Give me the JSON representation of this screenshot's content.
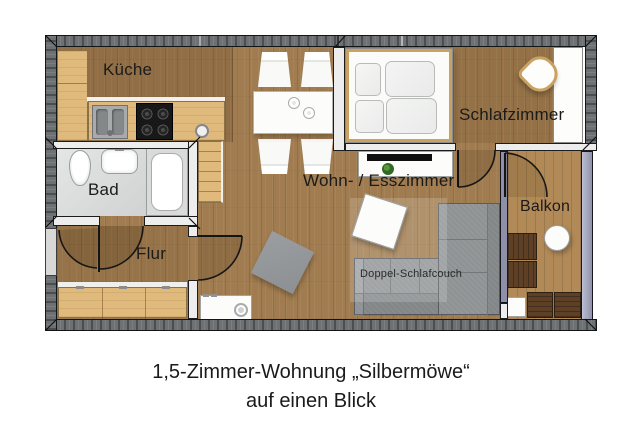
{
  "labels": {
    "kueche": "Küche",
    "bad": "Bad",
    "flur": "Flur",
    "wohn_esszimmer": "Wohn- / Esszimmer",
    "schlafzimmer": "Schlafzimmer",
    "balkon": "Balkon",
    "schlafcouch": "Doppel-Schlafcouch"
  },
  "caption": {
    "line1": "1,5-Zimmer-Wohnung „Silbermöwe“",
    "line2": "auf einen Blick"
  },
  "colors": {
    "wall-dark": "#6d7173",
    "wall-light": "#ededed",
    "wood-floor": "#a07c50",
    "wood-furniture": "#e0ba7d",
    "balcony-wood": "#b28a58",
    "railing-slate": "#9fa2bd",
    "divider-slate": "#8d90a8",
    "couch-gray": "#8f9294",
    "bath-tile": "#d6d8d8",
    "dark-chair": "#5e4026",
    "frame-wood": "#c9a262",
    "text": "#1b1b1b"
  }
}
